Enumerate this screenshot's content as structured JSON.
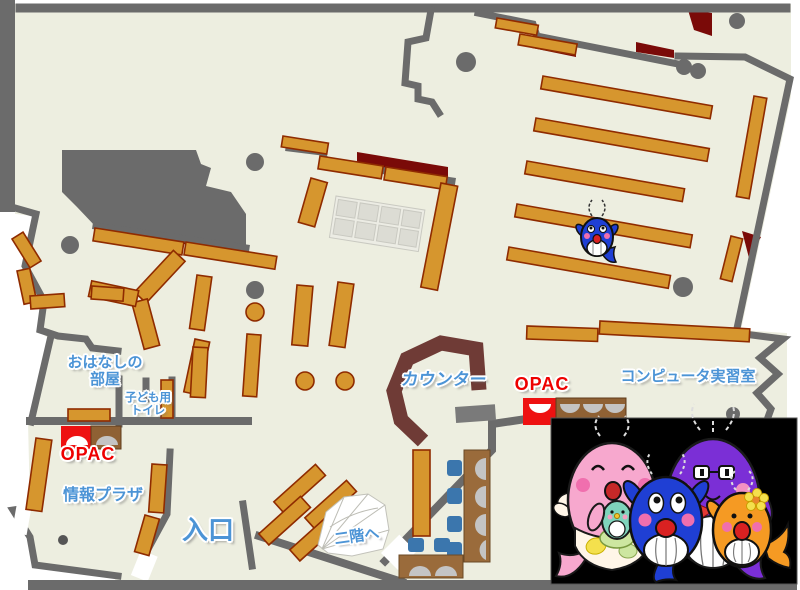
{
  "floor_map": {
    "title": "library-first-floor-map",
    "labels": {
      "storytelling_room_line1": "おはなしの",
      "storytelling_room_line2": "部屋",
      "kids_toilet_line1": "子ども用",
      "kids_toilet_line2": "トイレ",
      "opac_left": "OPAC",
      "opac_right": "OPAC",
      "counter": "カウンター",
      "computer_room": "コンピュータ実習室",
      "info_plaza": "情報プラザ",
      "entrance": "入口",
      "to_second_floor": "二階へ"
    },
    "colors": {
      "floor": "#EDEEE0",
      "wall": "#6B6B6B",
      "shelf_fill": "#D6962E",
      "shelf_border": "#8F2B00",
      "dark_red_area": "#7A0A08",
      "counter": "#6F3B36",
      "opac_red": "#EE0000",
      "desk_brown": "#9A6B3B",
      "chair_blue": "#3B76AD",
      "monitor_gray": "#C4C4C4",
      "label_blue": "#4C94D6",
      "label_red": "#EE0000",
      "mascot_panel_bg": "#000000"
    },
    "mascots": {
      "panel_characters": [
        "pink-whale-mother",
        "teal-whale-baby",
        "blue-whale-child",
        "purple-whale-father",
        "orange-whale-child"
      ],
      "on_shelf_character": "blue-whale"
    }
  }
}
